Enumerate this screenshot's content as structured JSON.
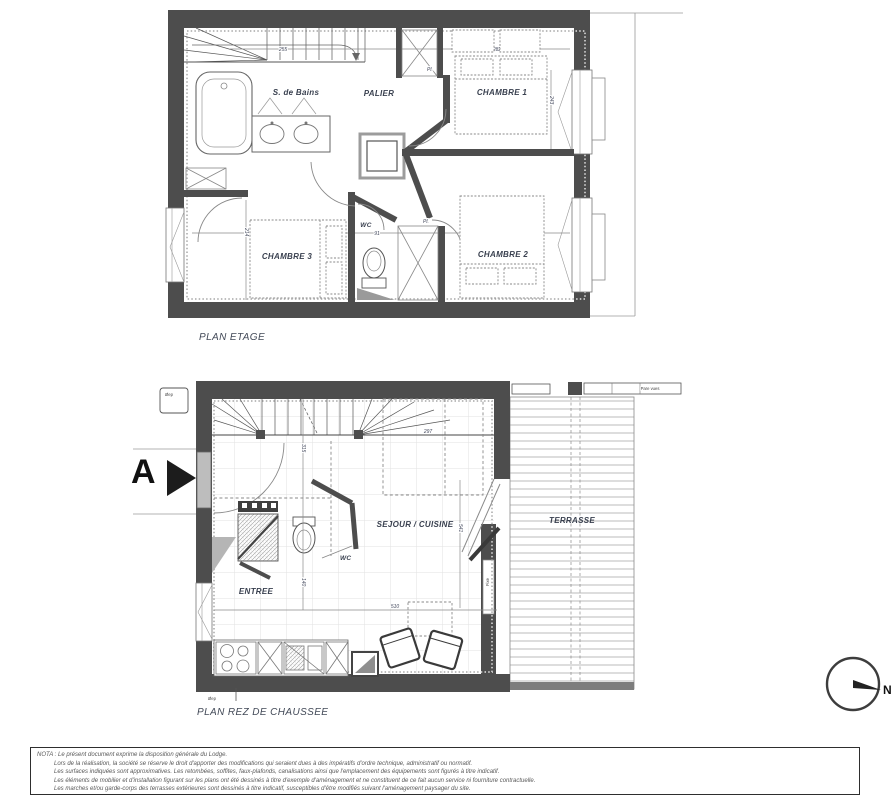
{
  "floor_plans": {
    "etage": {
      "title": "PLAN ETAGE",
      "rooms": {
        "bathroom": "S. de Bains",
        "landing": "PALIER",
        "bedroom1": "CHAMBRE 1",
        "bedroom2": "CHAMBRE 2",
        "bedroom3": "CHAMBRE 3",
        "wc": "WC"
      },
      "closet_top": "Pl.",
      "closet_bottom": "Pl.",
      "dimensions": {
        "stairs_width": "255",
        "bedroom1_width": "282",
        "bedroom3_width": "255",
        "wc_width": "91",
        "bedroom2_width": "306",
        "bedroom3_depth": "214",
        "bedroom1_depth": "243"
      }
    },
    "rdc": {
      "title": "PLAN REZ DE CHAUSSEE",
      "rooms": {
        "living_kitchen": "SEJOUR / CUISINE",
        "terrace": "TERRASSE",
        "entry": "ENTREE",
        "wc": "WC"
      },
      "dimensions": {
        "stairs_depth": "315",
        "stairs_width": "297",
        "living_width": "510",
        "entry_depth": "140",
        "bay_height": "541"
      },
      "annotations": {
        "fixed_window": "Fixe",
        "screen": "Pare vues",
        "downspout_top": "Øep",
        "downspout_bottom": "Øep"
      }
    }
  },
  "section_marker": {
    "label": "A"
  },
  "compass": {
    "label": "N"
  },
  "nota": {
    "lines": [
      "NOTA : Le présent document exprime la disposition générale du Lodge.",
      "Lors de la réalisation, la société se réserve le droit d'apporter des modifications qui seraient dues à des impératifs d'ordre technique, administratif ou normatif.",
      "Les surfaces indiquées sont approximatives. Les retombées, soffites, faux-plafonds, canalisations ainsi que l'emplacement des équipements sont figurés à titre indicatif.",
      "Les éléments de mobilier et d'installation figurant sur les plans ont été dessinés à titre d'exemple d'aménagement et ne constituent de ce fait aucun service ni fourniture contractuelle.",
      "Les marches et/ou garde-corps des terrasses extérieures sont dessinés à titre indicatif, susceptibles d'être modifiés suivant l'aménagement paysager du site."
    ]
  },
  "colors": {
    "wall": "#4d4d4d",
    "label": "#39404f",
    "grid": "#e2e2e2"
  }
}
